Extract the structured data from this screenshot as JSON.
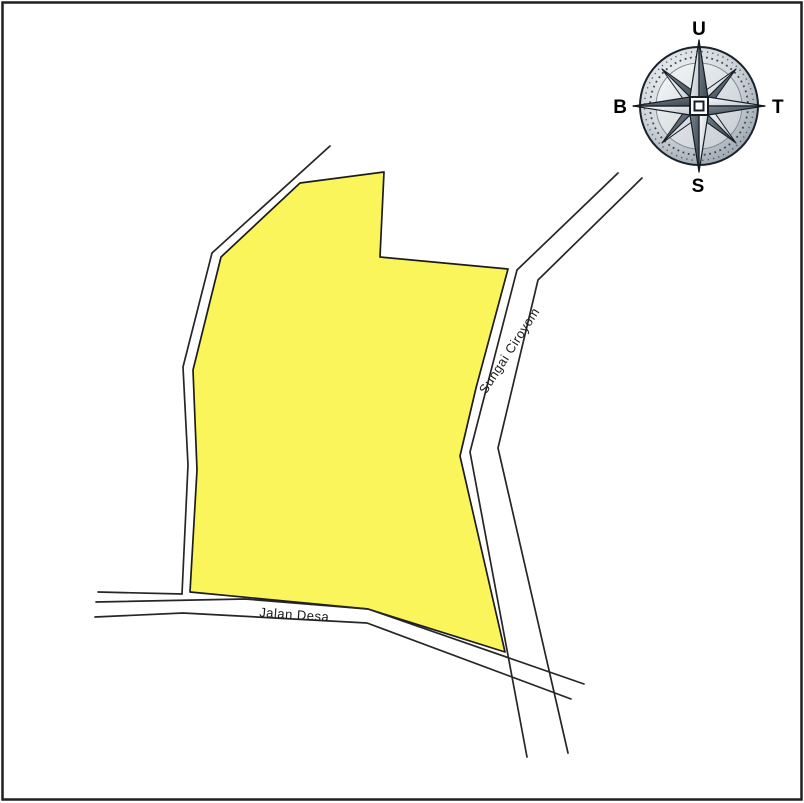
{
  "canvas": {
    "background": "#ffffff",
    "border_color": "#1f1f1f",
    "line_color": "#262626"
  },
  "parcel": {
    "fill": "#FBF55C",
    "points": "300,183 384,172 380,257 508,269 476,388 460,456 505,652 368,609 190,592 197,470 193,370 221,257"
  },
  "boundary": {
    "main_line": "330,146 212,253 183,367 188,465 182,594",
    "spur_line": "98,592 182,594"
  },
  "river": {
    "label": "Sungai Ciroyom",
    "left_bank": "618,173 517,270 470,452 527,757",
    "right_bank": "642,178 538,280 498,448 568,753"
  },
  "road": {
    "label": "Jalan Desa",
    "top_edge": "96,602 245,599 368,609 584,684",
    "bottom_edge": "95,617 183,613 367,623 571,699"
  },
  "compass": {
    "north": "U",
    "east": "T",
    "south": "S",
    "west": "B",
    "ring_color": "#9aa4ad",
    "star_light": "#f0f2f4",
    "star_dark": "#5b6670"
  }
}
